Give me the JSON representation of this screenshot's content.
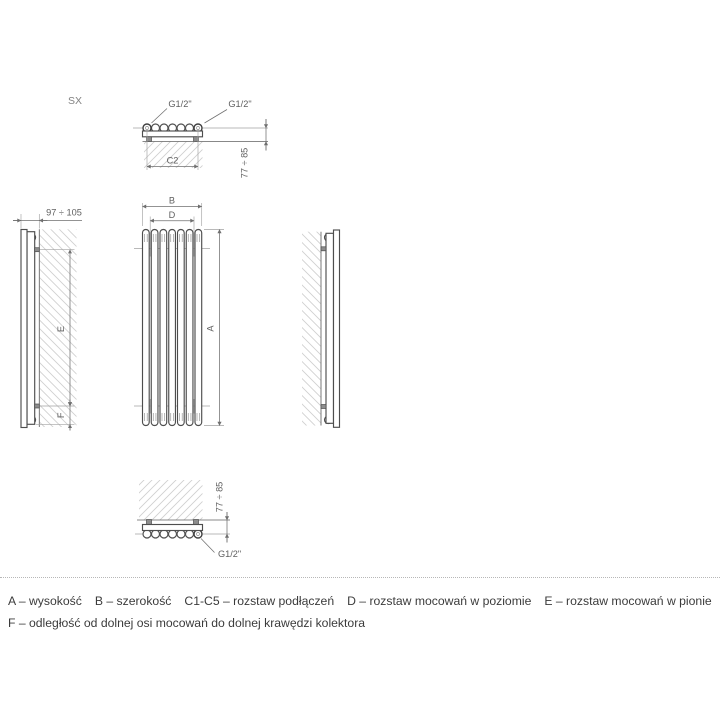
{
  "diagram": {
    "model_label": "SX",
    "colors": {
      "line": "#4e4e4e",
      "dim": "#6f6f6f",
      "ext": "#a2a2a2",
      "text": "#5f5f5f",
      "bracket": "#8d8d8d",
      "hatch": "#cfcfcf"
    },
    "top_view": {
      "connection_left": "G1/2\"",
      "connection_right": "G1/2\"",
      "dim_connections": "C2",
      "dim_depth": "77 ÷ 85"
    },
    "front_view": {
      "dim_width": "B",
      "dim_mount_horizontal": "D",
      "dim_height": "A"
    },
    "left_view": {
      "dim_wall_distance": "97 ÷ 105",
      "dim_mount_vertical": "E",
      "dim_bottom_offset": "F"
    },
    "bottom_view": {
      "dim_depth": "77 ÷ 85",
      "connection": "G1/2\""
    }
  },
  "legend": {
    "line1_items": [
      "A – wysokość",
      "B – szerokość",
      "C1-C5 – rozstaw podłączeń",
      "D – rozstaw mocowań w poziomie",
      "E – rozstaw mocowań w pionie"
    ],
    "line2": "F – odległość od dolnej osi mocowań do dolnej krawędzi kolektora"
  }
}
